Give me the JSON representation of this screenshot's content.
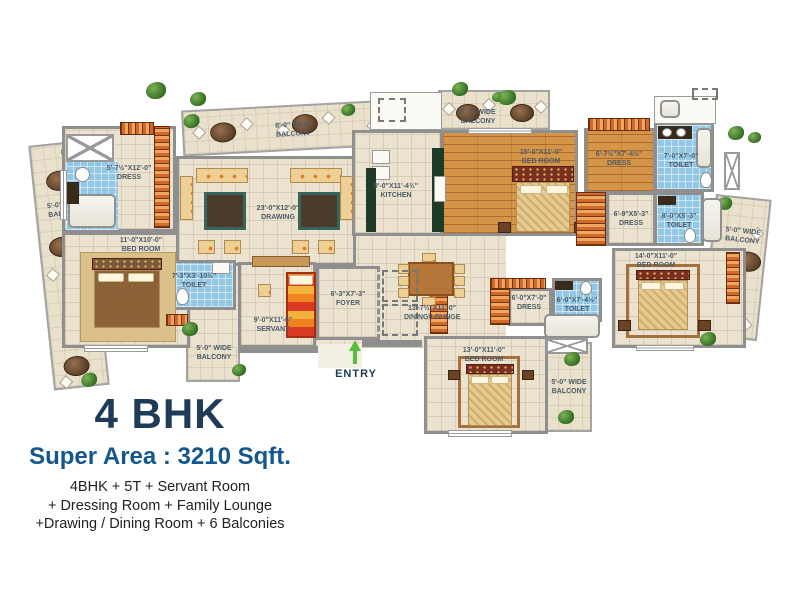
{
  "title": {
    "bhk": "4 BHK",
    "super_area": "Super Area : 3210 Sqft.",
    "features_line1": "4BHK + 5T + Servant Room",
    "features_line2": "+ Dressing Room + Family Lounge",
    "features_line3": "+Drawing / Dining Room + 6 Balconies"
  },
  "entry": {
    "label": "ENTRY"
  },
  "rooms": {
    "drawing": {
      "dims": "23'-0\"X12'-0\"",
      "name": "DRAWING"
    },
    "kitchen": {
      "dims": "9'-0\"X11'-4½\"",
      "name": "KITCHEN"
    },
    "dining": {
      "dims": "13'-7½\"X11'-0\"",
      "name": "DINING\\LOUNGE"
    },
    "foyer": {
      "dims": "6'-3\"X7'-3\"",
      "name": "FOYER"
    },
    "servant": {
      "dims": "9'-0\"X11'-6\"",
      "name": "SERVANT"
    },
    "bed1": {
      "dims": "11'-0\"X10'-0\"",
      "name": "BED ROOM"
    },
    "dress1": {
      "dims": "5'-7½\"X12'-0\"",
      "name": "DRESS"
    },
    "toilet1": {
      "dims": "7'-3\"X3'-10½\"",
      "name": "TOILET"
    },
    "bed2": {
      "dims": "15'-0\"X11'-0\"",
      "name": "BED ROOM"
    },
    "dress2": {
      "dims": "6'-7½\"X7'-4½\"",
      "name": "DRESS"
    },
    "toilet2": {
      "dims": "7'-0\"X7'-0\"",
      "name": "TOILET"
    },
    "dress3": {
      "dims": "6'-9\"X5'-3\"",
      "name": "DRESS"
    },
    "toilet3": {
      "dims": "8'-0\"X5'-3\"",
      "name": "TOILET"
    },
    "bed3": {
      "dims": "14'-0\"X11'-0\"",
      "name": "BED ROOM"
    },
    "dress4": {
      "dims": "6'-0\"X7'-0\"",
      "name": "DRESS"
    },
    "toilet4": {
      "dims": "6'-0\"X7'-4½\"",
      "name": "TOILET"
    },
    "bed4": {
      "dims": "13'-0\"X11'-0\"",
      "name": "BED ROOM"
    }
  },
  "balconies": {
    "top_wide": {
      "dims": "8'-0\" WIDE",
      "name": "BALCONY"
    },
    "top_right": {
      "dims": "5'-0\" WIDE",
      "name": "BALCONY"
    },
    "left": {
      "dims": "5'-0\" WIDE",
      "name": "BALCONY"
    },
    "right": {
      "dims": "5'-0\" WIDE",
      "name": "BALCONY"
    },
    "bottom": {
      "dims": "5'-0\" WIDE",
      "name": "BALCONY"
    },
    "small_left": {
      "dims": "5'-0\" WIDE",
      "name": "BALCONY"
    }
  },
  "colors": {
    "floor": "#ebe3d0",
    "wall": "#8f8f8f",
    "wood_floor": "#d59549",
    "toilet_tile": "#92c8e6",
    "title_navy": "#1e3c59",
    "title_blue": "#14578f",
    "body_text": "#222222",
    "entry_green": "#57c038",
    "plant_green": "#3f7a28",
    "label_text": "#4d5a68"
  }
}
